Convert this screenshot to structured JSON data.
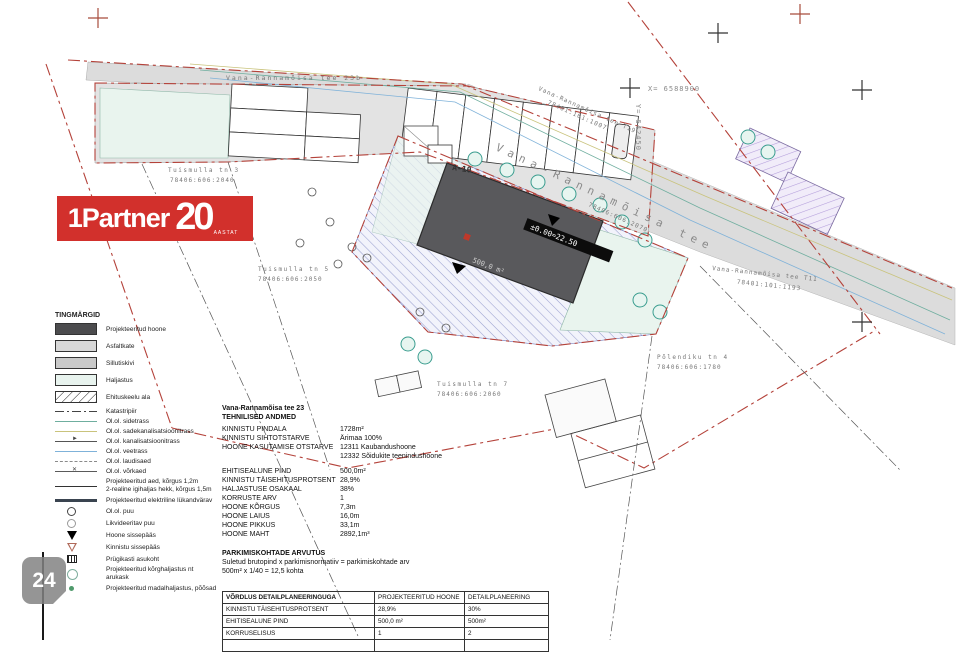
{
  "logo": {
    "prefix": "1",
    "name": "Partner",
    "number": "20",
    "suffix": "AASTAT"
  },
  "watermark": {
    "number": "24"
  },
  "legend": {
    "title": "TINGMÄRGID",
    "items": [
      {
        "label": "Projekteeritud hoone"
      },
      {
        "label": "Asfaltkate"
      },
      {
        "label": "Sillutiskivi"
      },
      {
        "label": "Haljastus"
      },
      {
        "label": "Ehituskeelu ala"
      },
      {
        "label": "Katastripiir"
      },
      {
        "label": "Ol.ol. sidetrass"
      },
      {
        "label": "Ol.ol. sadekanalisatsioonitrass"
      },
      {
        "label": "Ol.ol. kanalisatsioonitrass"
      },
      {
        "label": "Ol.ol. veetrass"
      },
      {
        "label": "Ol.ol. laudisaed"
      },
      {
        "label": "Ol.ol. võrkaed"
      },
      {
        "label": "Projekteeritud aed, kõrgus 1,2m",
        "label2": "2-realine igihaljas hekk, kõrgus 1,5m"
      },
      {
        "label": "Projekteeritud elektriline lükandvärav"
      },
      {
        "label": "Ol.ol. puu"
      },
      {
        "label": "Likvideeritav puu"
      },
      {
        "label": "Hoone sissepääs"
      },
      {
        "label": "Kinnistu sissepääs"
      },
      {
        "label": "Prügikasti asukoht"
      },
      {
        "label": "Projekteeritud kõrghaljastus nt",
        "label2": "arukask"
      },
      {
        "label": "Projekteeritud madalhaljastus, põõsad"
      }
    ]
  },
  "info": {
    "address": "Vana-Rannamõisa tee 23",
    "tech_title": "TEHNILISED ANDMED",
    "rows": [
      {
        "k": "KINNISTU PINDALA",
        "v": "1728m²"
      },
      {
        "k": "KINNISTU SIHTOTSTARVE",
        "v": "Ärimaa 100%"
      },
      {
        "k": "HOONE KASUTAMISE OTSTARVE",
        "v": "12311 Kaubandushoone",
        "v2": "12332 Sõidukite teenindushoone"
      },
      {
        "k": "EHITISEALUNE PIND",
        "v": "500,0m²"
      },
      {
        "k": "KINNISTU TÄISEHITUSPROTSENT",
        "v": "28,9%"
      },
      {
        "k": "HALJASTUSE OSAKAAL",
        "v": "38%"
      },
      {
        "k": "KORRUSTE ARV",
        "v": "1"
      },
      {
        "k": "HOONE KÕRGUS",
        "v": "7,3m"
      },
      {
        "k": "HOONE LAIUS",
        "v": "16,0m"
      },
      {
        "k": "HOONE PIKKUS",
        "v": "33,1m"
      },
      {
        "k": "HOONE MAHT",
        "v": "2892,1m³"
      }
    ],
    "parking_title": "PARKIMISKOHTADE ARVUTUS",
    "parking_line1": "Suletud brutopind x parkimisnormatiiv = parkimiskohtade arv",
    "parking_line2": "500m² x 1/40 = 12,5 kohta"
  },
  "table": {
    "headers": [
      "VÕRDLUS DETAILPLANEERINGUGA",
      "PROJEKTEERITUD HOONE",
      "DETAILPLANEERING"
    ],
    "rows": [
      [
        "KINNISTU TÄISEHITUSPROTSENT",
        "28,9%",
        "30%"
      ],
      [
        "EHITISEALUNE PIND",
        "500,0 m²",
        "500m²"
      ],
      [
        "KORRUSELISUS",
        "1",
        "2"
      ]
    ]
  },
  "map": {
    "labels": {
      "street_23b": "Vana-Rannamõisa tee 23b",
      "street_main": "Vana-Rannamõisa tee",
      "street_t19": "Vana-Rannamõisa tee T19",
      "cad_t19": "78401:101:1007",
      "road_cad": "78406:606:2070",
      "street_t11": "Vana-Rannamõisa tee T11",
      "cad_t11": "78401:101:1193",
      "tuismulla3": "Tuismulla tn 3",
      "cad3": "78406:606:2040",
      "tuismulla5": "Tuismulla tn 5",
      "cad5": "78406:606:2050",
      "tuismulla7": "Tuismulla tn 7",
      "cad7": "78406:606:2060",
      "polendiku4": "Põlendiku tn 4",
      "cad_polendiku": "78406:606:1780",
      "coord_x": "X= 6588900",
      "coord_y": "Y= 542450",
      "building_area": "500,0 m²",
      "building_level": "±0.00=22.50",
      "parking_row": "A-10"
    }
  }
}
